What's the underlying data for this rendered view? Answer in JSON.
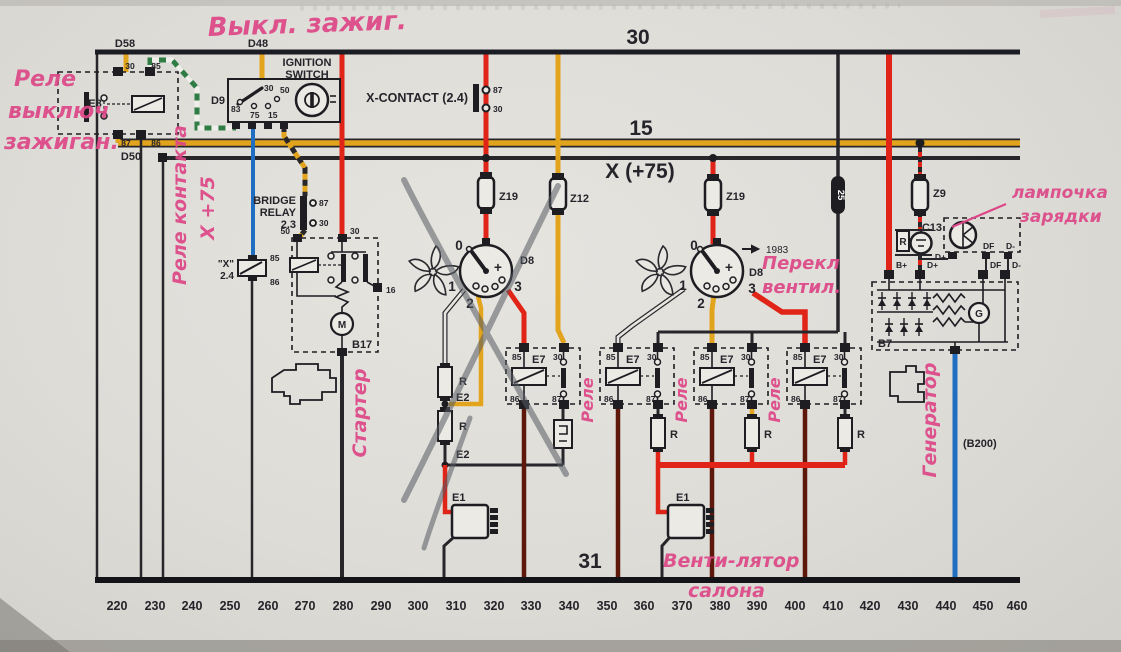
{
  "buses": {
    "b30": "30",
    "b15": "15",
    "x75": "X (+75)",
    "b31": "31"
  },
  "ruler": [
    "220",
    "230",
    "240",
    "250",
    "260",
    "270",
    "280",
    "290",
    "300",
    "310",
    "320",
    "330",
    "340",
    "350",
    "360",
    "370",
    "380",
    "390",
    "400",
    "410",
    "420",
    "430",
    "440",
    "450",
    "460"
  ],
  "colors": {
    "red": "#e02418",
    "yellow": "#e2a31d",
    "blue": "#1f6ec2",
    "maroon": "#5d170b",
    "green": "#2f7d45",
    "pink": "#dd4787"
  },
  "components": {
    "d58": "D58",
    "d48": "D48",
    "d50": "D50",
    "e8": "E8",
    "d9": "D9",
    "ignition1": "IGNITION",
    "ignition2": "SWITCH",
    "x_contact": "X-CONTACT (2.4)",
    "bridge1": "BRIDGE",
    "bridge2": "RELAY",
    "bridge3": "2.3",
    "b17": "B17",
    "m": "M",
    "x24a": "\"X\"",
    "x24b": "2.4",
    "z19": "Z19",
    "z12": "Z12",
    "z9": "Z9",
    "fuse25": "25",
    "d8": "D8",
    "year": "1983",
    "e7": "E7",
    "r": "R",
    "e2": "E2",
    "e1": "E1",
    "c13": "C13",
    "b7": "B7",
    "g": "G",
    "b200": "(B200)",
    "bplus": "B+",
    "dplus": "D+",
    "df": "DF",
    "dminus": "D-"
  },
  "terminals": {
    "t30": "30",
    "t85": "85",
    "t86": "86",
    "t87": "87",
    "t50": "50",
    "t75": "75",
    "t15": "15",
    "t83": "83",
    "t16": "16",
    "p0": "0",
    "p1": "1",
    "p2": "2",
    "p3": "3",
    "plus": "+"
  },
  "annotations": {
    "ignition_off": "Выкл. зажиг.",
    "relay_ign_1": "Реле",
    "relay_ign_2": "выключ",
    "relay_ign_3": "зажиган.",
    "contact_relay_1": "Реле контакта",
    "contact_relay_2": "X +75",
    "starter": "Стартер",
    "relay": "Реле",
    "fan_switch_1": "Перекл",
    "fan_switch_2": "вентил.",
    "charge_lamp_1": "лампочка",
    "charge_lamp_2": "зарядки",
    "generator": "Генератор",
    "cabin_fan_1": "Венти-лятор",
    "cabin_fan_2": "салона"
  }
}
